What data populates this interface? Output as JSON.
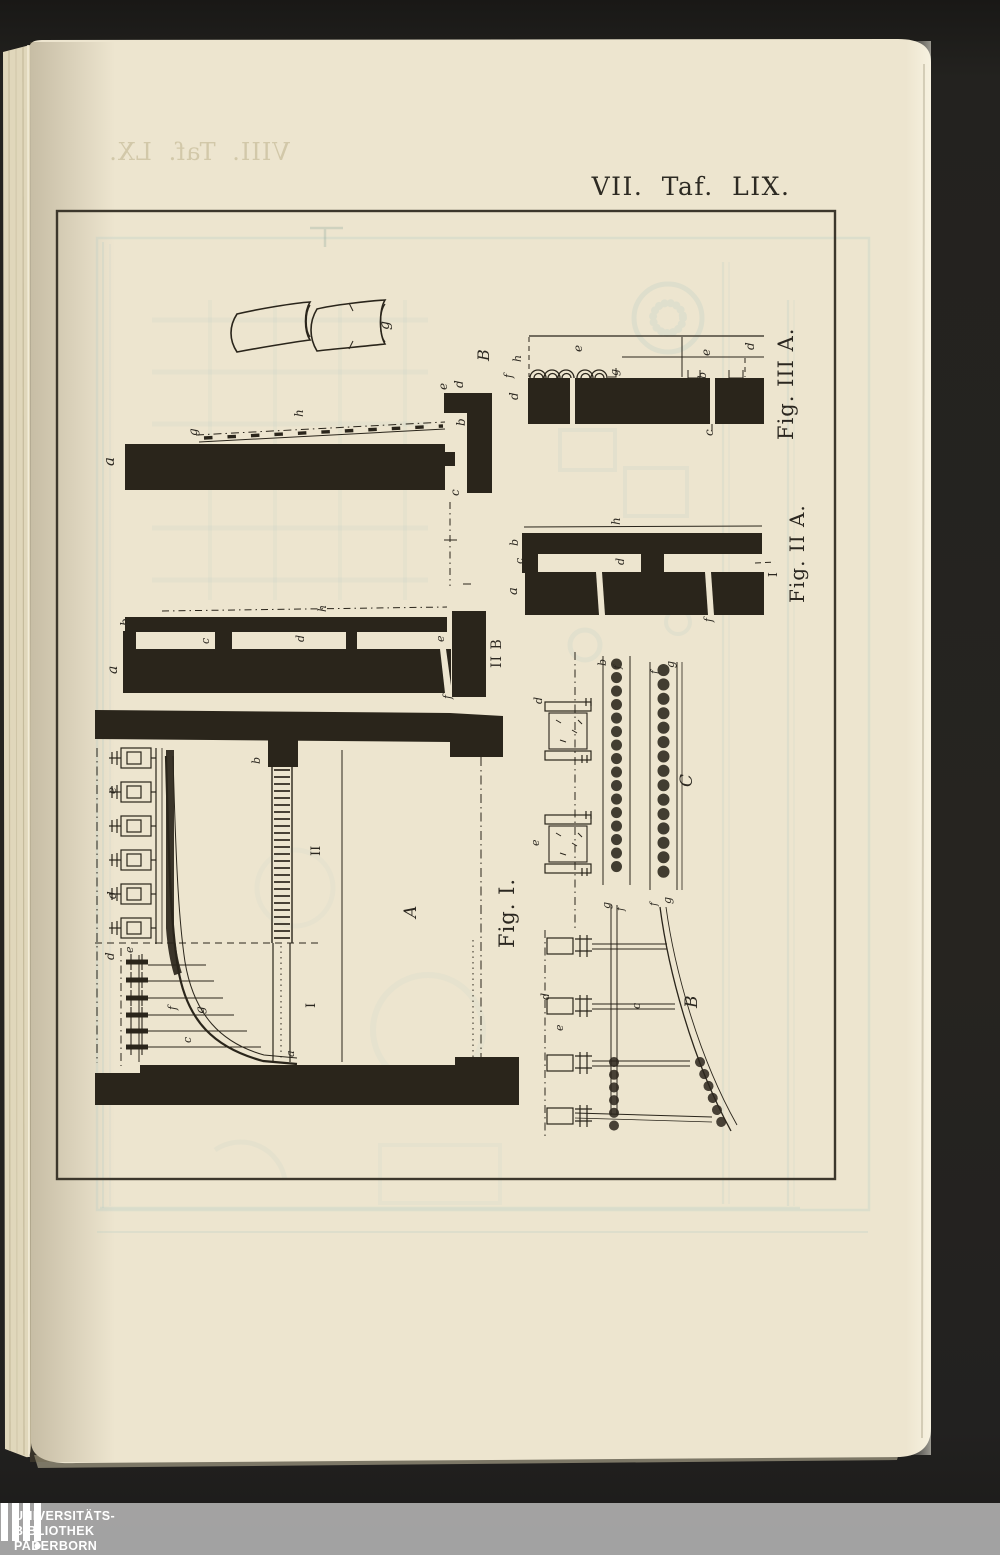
{
  "page": {
    "title": "VII.  Taf.  LIX.",
    "bleedthrough_title": "VIII. Taf. LX."
  },
  "plate": {
    "captions": {
      "fig1": "Fig. I.",
      "fig2a": "Fig. II A.",
      "fig3a": "Fig. III A.",
      "fig2b": "II B"
    },
    "labels": [
      {
        "t": "g",
        "x": 389,
        "y": 330,
        "i": 1,
        "s": 14
      },
      {
        "t": "a",
        "x": 114,
        "y": 466,
        "i": 1,
        "s": 15
      },
      {
        "t": "g",
        "x": 197,
        "y": 436,
        "i": 1,
        "s": 12
      },
      {
        "t": "h",
        "x": 303,
        "y": 417,
        "i": 1,
        "s": 12
      },
      {
        "t": "e",
        "x": 447,
        "y": 390,
        "i": 1,
        "s": 12
      },
      {
        "t": "d",
        "x": 463,
        "y": 388,
        "i": 1,
        "s": 12
      },
      {
        "t": "b",
        "x": 465,
        "y": 426,
        "i": 1,
        "s": 12
      },
      {
        "t": "c",
        "x": 459,
        "y": 496,
        "i": 1,
        "s": 12
      },
      {
        "t": "B",
        "x": 489,
        "y": 361,
        "i": 1,
        "s": 16
      },
      {
        "t": "d",
        "x": 518,
        "y": 400,
        "i": 1,
        "s": 12
      },
      {
        "t": "f",
        "x": 512,
        "y": 378,
        "i": 1,
        "s": 11
      },
      {
        "t": "h",
        "x": 521,
        "y": 362,
        "i": 1,
        "s": 11
      },
      {
        "t": "e",
        "x": 582,
        "y": 352,
        "i": 1,
        "s": 12
      },
      {
        "t": "g",
        "x": 618,
        "y": 376,
        "i": 1,
        "s": 11
      },
      {
        "t": "b",
        "x": 706,
        "y": 379,
        "i": 1,
        "s": 11
      },
      {
        "t": "e",
        "x": 710,
        "y": 356,
        "i": 1,
        "s": 12
      },
      {
        "t": "d",
        "x": 754,
        "y": 350,
        "i": 1,
        "s": 12
      },
      {
        "t": "c",
        "x": 713,
        "y": 436,
        "i": 1,
        "s": 12
      },
      {
        "t": "h",
        "x": 620,
        "y": 525,
        "i": 1,
        "s": 12
      },
      {
        "t": "b",
        "x": 518,
        "y": 546,
        "i": 1,
        "s": 11
      },
      {
        "t": "c",
        "x": 523,
        "y": 564,
        "i": 1,
        "s": 11
      },
      {
        "t": "a",
        "x": 517,
        "y": 595,
        "i": 1,
        "s": 13
      },
      {
        "t": "d",
        "x": 624,
        "y": 565,
        "i": 1,
        "s": 11
      },
      {
        "t": "f",
        "x": 712,
        "y": 622,
        "i": 1,
        "s": 11
      },
      {
        "t": "I",
        "x": 777,
        "y": 577,
        "s": 12
      },
      {
        "t": "b",
        "x": 129,
        "y": 626,
        "i": 1,
        "s": 12
      },
      {
        "t": "a",
        "x": 117,
        "y": 674,
        "i": 1,
        "s": 14
      },
      {
        "t": "c",
        "x": 209,
        "y": 644,
        "i": 1,
        "s": 11
      },
      {
        "t": "d",
        "x": 304,
        "y": 642,
        "i": 1,
        "s": 11
      },
      {
        "t": "h",
        "x": 326,
        "y": 612,
        "i": 1,
        "s": 11
      },
      {
        "t": "e",
        "x": 444,
        "y": 642,
        "i": 1,
        "s": 11
      },
      {
        "t": "f",
        "x": 451,
        "y": 699,
        "i": 1,
        "s": 11
      },
      {
        "t": "e",
        "x": 116,
        "y": 794,
        "i": 1,
        "s": 12
      },
      {
        "t": "d",
        "x": 116,
        "y": 899,
        "i": 1,
        "s": 12
      },
      {
        "t": "d",
        "x": 114,
        "y": 960,
        "i": 1,
        "s": 12
      },
      {
        "t": "e",
        "x": 133,
        "y": 953,
        "i": 1,
        "s": 11
      },
      {
        "t": "f",
        "x": 176,
        "y": 1010,
        "i": 1,
        "s": 11
      },
      {
        "t": "g",
        "x": 204,
        "y": 1014,
        "i": 1,
        "s": 12
      },
      {
        "t": "c",
        "x": 191,
        "y": 1043,
        "i": 1,
        "s": 11
      },
      {
        "t": "b",
        "x": 260,
        "y": 764,
        "i": 1,
        "s": 11
      },
      {
        "t": "a",
        "x": 294,
        "y": 1057,
        "i": 1,
        "s": 11
      },
      {
        "t": "II",
        "x": 320,
        "y": 856,
        "s": 13
      },
      {
        "t": "I",
        "x": 315,
        "y": 1008,
        "s": 13
      },
      {
        "t": "A",
        "x": 416,
        "y": 918,
        "i": 1,
        "s": 17
      },
      {
        "t": "d",
        "x": 542,
        "y": 704,
        "i": 1,
        "s": 11
      },
      {
        "t": "e",
        "x": 539,
        "y": 846,
        "i": 1,
        "s": 11
      },
      {
        "t": "b",
        "x": 606,
        "y": 666,
        "i": 1,
        "s": 11
      },
      {
        "t": "f",
        "x": 621,
        "y": 669,
        "i": 1,
        "s": 10
      },
      {
        "t": "f",
        "x": 658,
        "y": 674,
        "i": 1,
        "s": 10
      },
      {
        "t": "g",
        "x": 674,
        "y": 668,
        "i": 1,
        "s": 11
      },
      {
        "t": "C",
        "x": 692,
        "y": 787,
        "i": 1,
        "s": 17
      },
      {
        "t": "g",
        "x": 610,
        "y": 909,
        "i": 1,
        "s": 11
      },
      {
        "t": "f",
        "x": 624,
        "y": 911,
        "i": 1,
        "s": 10
      },
      {
        "t": "f",
        "x": 657,
        "y": 906,
        "i": 1,
        "s": 10
      },
      {
        "t": "g",
        "x": 671,
        "y": 904,
        "i": 1,
        "s": 11
      },
      {
        "t": "d",
        "x": 549,
        "y": 1000,
        "i": 1,
        "s": 11
      },
      {
        "t": "e",
        "x": 563,
        "y": 1031,
        "i": 1,
        "s": 11
      },
      {
        "t": "c",
        "x": 640,
        "y": 1009,
        "i": 1,
        "s": 11
      },
      {
        "t": "B",
        "x": 697,
        "y": 1008,
        "i": 1,
        "s": 17
      }
    ]
  },
  "watermark": {
    "line1": "UNIVERSITÄTS-",
    "line2": "BIBLIOTHEK",
    "line3": "PADERBORN"
  },
  "colors": {
    "background": "#21201d",
    "page": "#ede5cf",
    "ink": "#2a251b",
    "ghost": "#b7cec6",
    "band": "#a7a7a7",
    "frame": "#3c372c"
  }
}
